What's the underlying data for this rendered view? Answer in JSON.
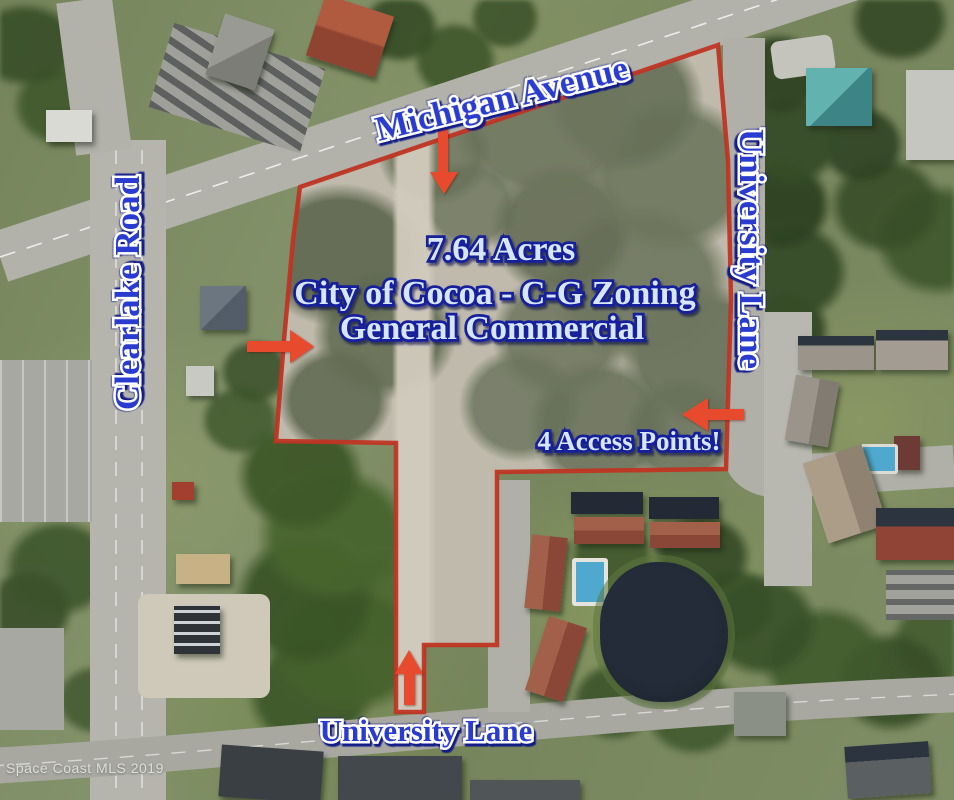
{
  "map": {
    "road_labels": {
      "top": "Michigan Avenue",
      "left": "Clearlake Road",
      "right": "University Lane",
      "bottom": "University Lane"
    },
    "parcel": {
      "acreage": "7.64 Acres",
      "zoning": "City of Cocoa - C-G Zoning",
      "zoning_description": "General Commercial",
      "access_note": "4 Access Points!"
    },
    "watermark": "Space Coast MLS 2019",
    "annotation_colors": {
      "boundary": "#c03524",
      "arrows": "#e84a2d",
      "road_label_fill": "#2a3cd0",
      "road_label_outline": "#ffffff",
      "info_label_fill": "#d8e6fb",
      "info_label_outline": "#16209c"
    },
    "arrows": [
      {
        "direction": "down",
        "location": "from Michigan Avenue into parcel"
      },
      {
        "direction": "right",
        "location": "west side access into parcel"
      },
      {
        "direction": "left",
        "location": "from University Lane into parcel"
      },
      {
        "direction": "up",
        "location": "from University Lane (south) into parcel"
      }
    ]
  }
}
